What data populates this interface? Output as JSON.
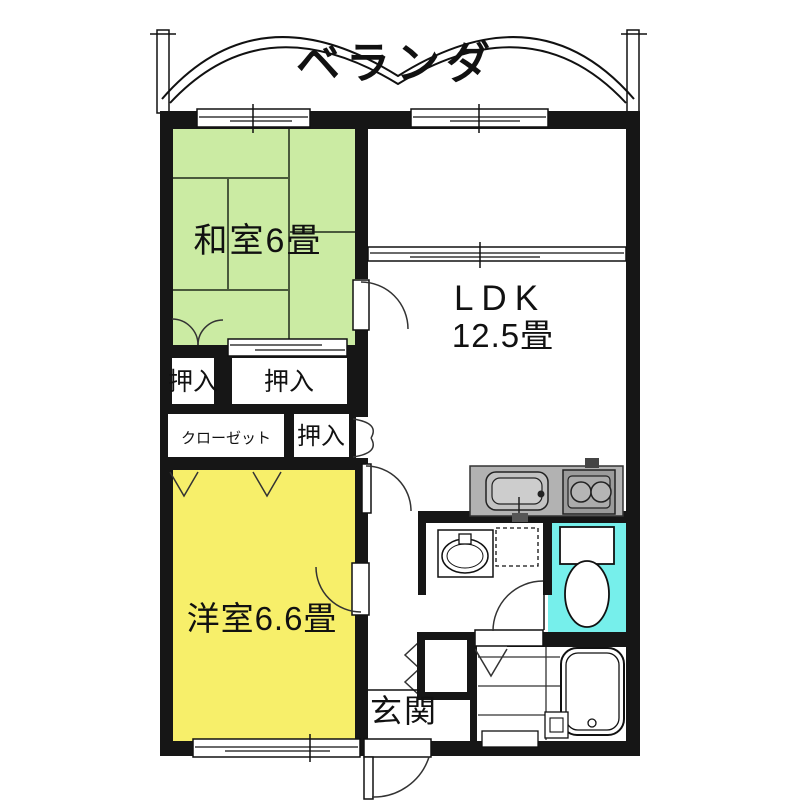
{
  "plan": {
    "balcony": {
      "label": "ベランダ"
    },
    "rooms": {
      "washitsu": {
        "label": "和室6畳",
        "color": "#cbeba3"
      },
      "ldk": {
        "label_1": "LDK",
        "label_2": "12.5畳"
      },
      "youshitsu": {
        "label": "洋室6.6畳",
        "color": "#f7ef6a"
      },
      "genkan": {
        "label": "玄関"
      },
      "toilet": {
        "color": "#76efeb"
      }
    },
    "storage": {
      "oshiire_top_left": {
        "label": "押入"
      },
      "oshiire_top_right": {
        "label": "押入"
      },
      "closet": {
        "label": "クローゼット"
      },
      "oshiire_lower": {
        "label": "押入"
      }
    },
    "colors": {
      "wall": "#161616",
      "tatami_line": "#4a5a3c",
      "counter": "#b2b2b2",
      "appliance": "#9b9b9b",
      "line": "#222222"
    }
  }
}
